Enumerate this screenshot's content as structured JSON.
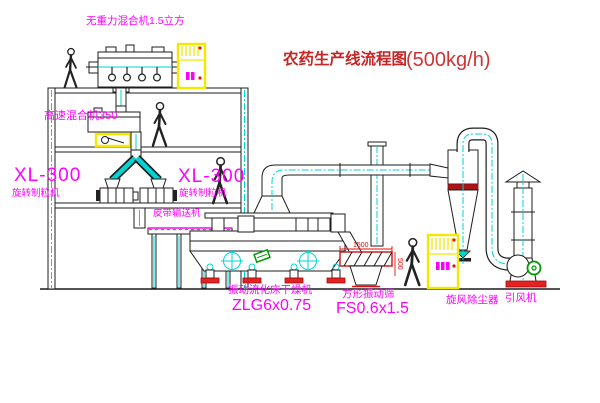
{
  "title": {
    "main": "农药生产线流程图",
    "capacity": "(500kg/h)"
  },
  "labels": {
    "gravity_mixer": "无重力混合机1.5立方",
    "high_speed_mixer": "高速混合机350",
    "granulator_left_model": "XL-300",
    "granulator_left_name": "旋转制粒机",
    "granulator_right_model": "XL-300",
    "granulator_right_name": "旋转制粒机",
    "belt_conveyor": "皮带输送机",
    "dryer_name": "振动流化床干燥机",
    "dryer_model": "ZLG6x0.75",
    "sieve_name": "方形振动筛",
    "sieve_model": "FS0.6x1.5",
    "cyclone": "旋风除尘器",
    "fan": "引风机"
  },
  "dimensions": {
    "sieve_length": "1500",
    "sieve_width": "500"
  },
  "colors": {
    "label_magenta": "#ff00ff",
    "title_red": "#c52525",
    "line_black": "#1c1c1c",
    "centerline_cyan": "#00d5d5",
    "cabinet_yellow": "#f5e800",
    "alert_red": "#e01010",
    "motor_green": "#009900"
  }
}
